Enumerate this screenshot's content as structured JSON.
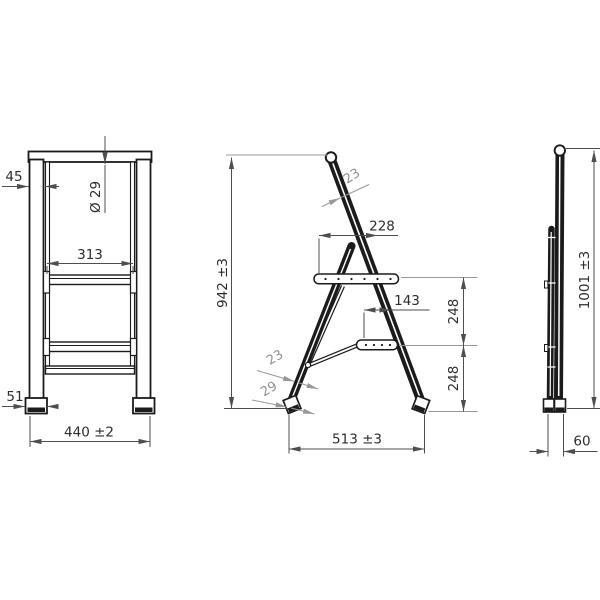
{
  "drawing": {
    "type": "technical-dimension-drawing",
    "subject": "folding two-step stool, three orthographic views",
    "colors": {
      "line": "#1b1b1b",
      "dimension": "#4e4e4e",
      "leader_gray": "#98989a",
      "background": "#ffffff"
    },
    "labels": {
      "front": {
        "leg_width": "45",
        "tube_dia": "Ø 29",
        "step_width": "313",
        "foot_width": "51",
        "overall_width": "440 ±2"
      },
      "side": {
        "rail_thickness": "23",
        "platform_depth": "228",
        "height": "942 ±3",
        "step_depth": "143",
        "spacing_upper": "248",
        "spacing_lower": "248",
        "leg_thickness": "23",
        "foot_width": "29",
        "footprint_depth": "513 ±3"
      },
      "folded": {
        "height": "1001 ±3",
        "depth": "60"
      }
    }
  }
}
